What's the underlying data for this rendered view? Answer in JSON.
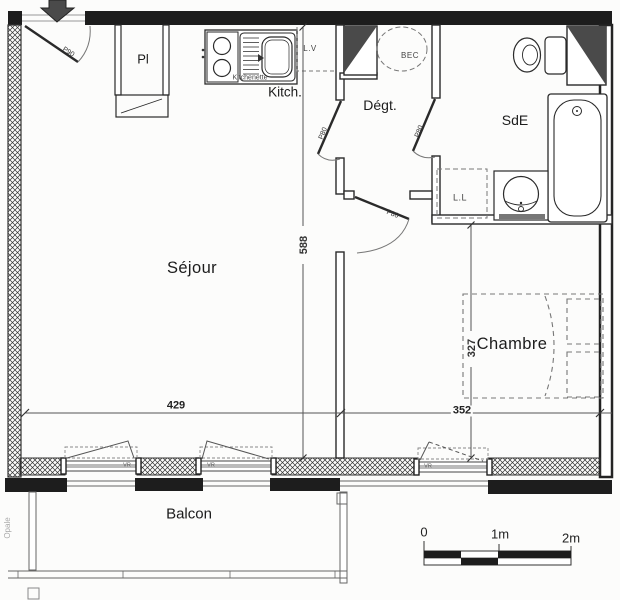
{
  "rooms": {
    "sejour": "Séjour",
    "chambre": "Chambre",
    "sde": "SdE",
    "degt": "Dégt.",
    "kitch": "Kitch.",
    "kitchenette": "Kitchenette",
    "placard": "Pl",
    "balcon": "Balcon"
  },
  "fixtures": {
    "dishwasher": "L.V",
    "washer": "L.L",
    "water_heater": "BEC"
  },
  "doors": {
    "entry": "P90",
    "interior": "P80"
  },
  "windows": {
    "shutter": "VR"
  },
  "dimensions": {
    "sejour_length": "588",
    "sejour_width": "429",
    "chambre_width": "352",
    "chambre_depth": "327"
  },
  "scale": {
    "zero": "0",
    "one": "1m",
    "two": "2m"
  },
  "watermark": "Opale",
  "colors": {
    "ink": "#2a2a2a",
    "fill_dark": "#4a4a4a"
  }
}
